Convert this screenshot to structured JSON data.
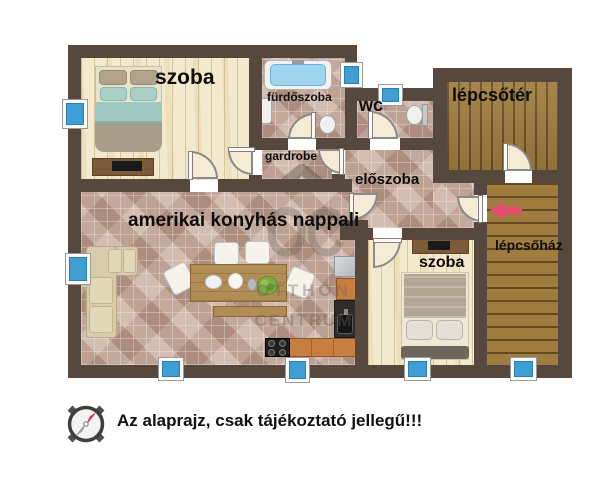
{
  "floorplan": {
    "labels": {
      "szoba1": "szoba",
      "furdoszoba": "fürdőszoba",
      "wc": "wc",
      "lepcsoter": "lépcsőtér",
      "gardrobe": "gardrobe",
      "eloszoba": "előszoba",
      "nappali": "amerikai konyhás nappali",
      "szoba2": "szoba",
      "lepcsohaz": "lépcsőház"
    },
    "watermark": {
      "initials": "OC",
      "line1": "OTTHON",
      "line2": "CENTRUM"
    },
    "disclaimer": "Az alaprajz, csak tájékoztató jellegű!!!",
    "colors": {
      "wall": "#57483e",
      "tile_floor": "#c3a99a",
      "pale_wood_floor": "#f3e9cc",
      "stair_wood": "#a07d3e",
      "window_glass": "#3f9fd4",
      "direction_arrow": "#e94a72"
    }
  }
}
